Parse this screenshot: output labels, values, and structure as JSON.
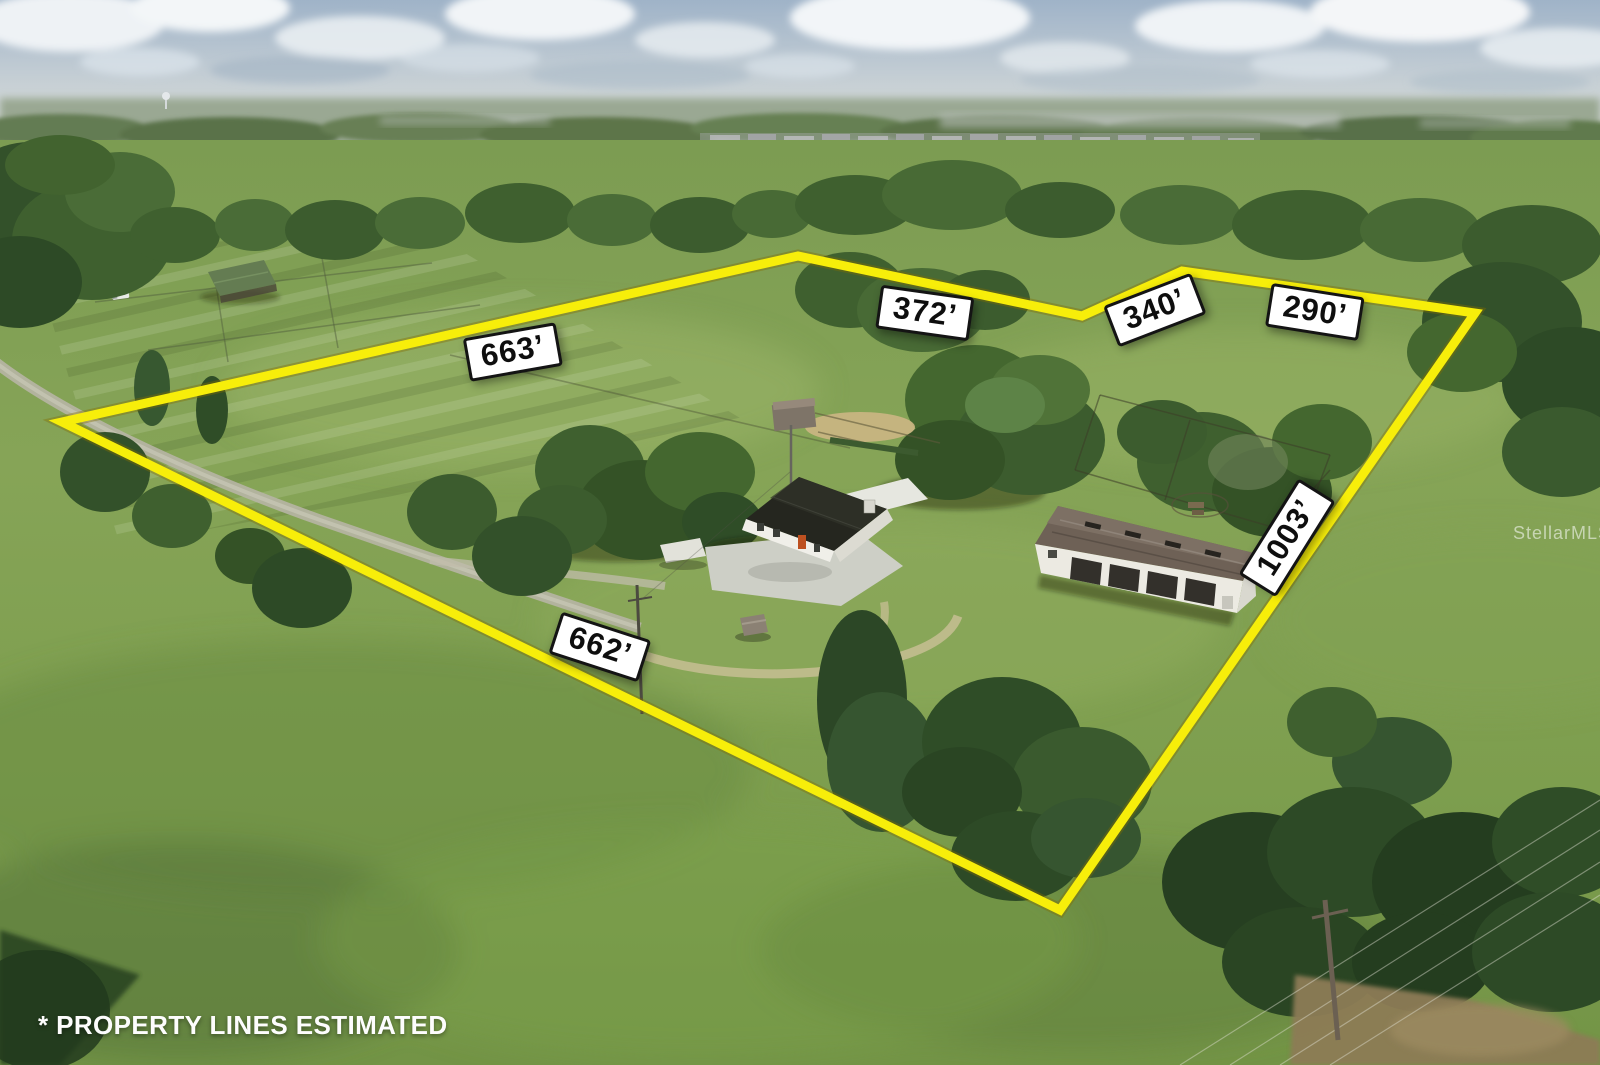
{
  "photo": {
    "watermark": "StellarMLS",
    "disclaimer": "* PROPERTY LINES ESTIMATED"
  },
  "property_lines": {
    "color": "#f7ee0a",
    "label_background": "#ffffff",
    "label_text_color": "#0e0e0e",
    "measurements": [
      {
        "side": "upper-left-boundary",
        "label": "663’"
      },
      {
        "side": "top-boundary",
        "label": "372’"
      },
      {
        "side": "top-notch-boundary",
        "label": "340’"
      },
      {
        "side": "top-right-boundary",
        "label": "290’"
      },
      {
        "side": "right-boundary",
        "label": "1003’"
      },
      {
        "side": "lower-left-boundary",
        "label": "662’"
      }
    ]
  }
}
